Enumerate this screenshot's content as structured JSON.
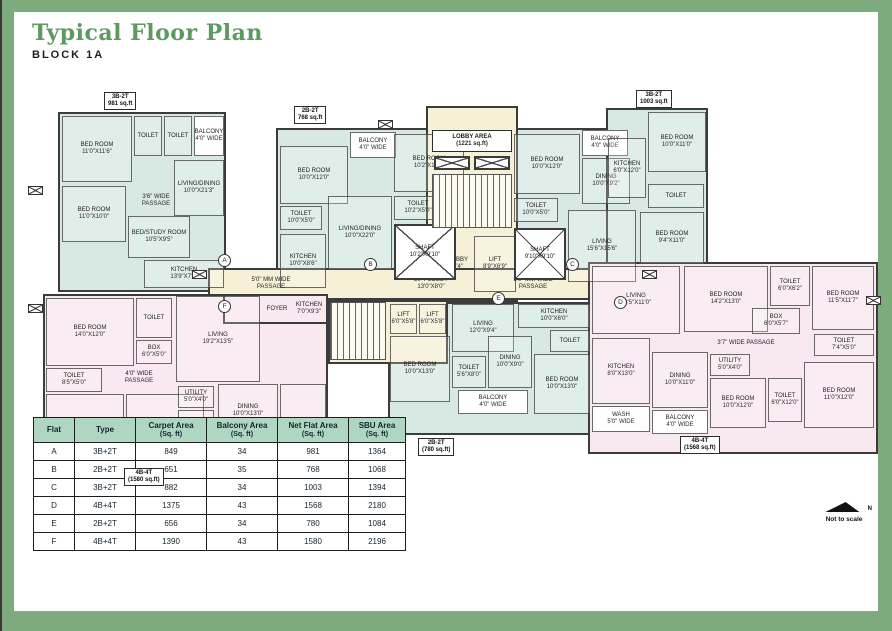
{
  "page": {
    "title": "Typical Floor Plan",
    "subtitle": "BLOCK 1A",
    "footer": {
      "north": "N",
      "note": "Not to scale"
    }
  },
  "colors": {
    "frame": "#7dab7d",
    "title": "#5d9a5f",
    "wall": "#3c3c3c",
    "teal_flat": "#d8e9e4",
    "pink_flat": "#f8e8f0",
    "lobby_cream": "#f6f0d6",
    "table_header": "#aed6c1"
  },
  "plan": {
    "zones": [
      {
        "name": "flat-a",
        "fill": "teal",
        "x": 30,
        "y": 22,
        "w": 168,
        "h": 180
      },
      {
        "name": "flat-b",
        "fill": "teal",
        "x": 248,
        "y": 38,
        "w": 192,
        "h": 172
      },
      {
        "name": "flat-c-main",
        "fill": "teal",
        "x": 482,
        "y": 38,
        "w": 178,
        "h": 172
      },
      {
        "name": "flat-c-wing",
        "fill": "teal",
        "x": 578,
        "y": 18,
        "w": 102,
        "h": 158
      },
      {
        "name": "lobby-tower",
        "fill": "cream",
        "x": 398,
        "y": 16,
        "w": 92,
        "h": 196
      },
      {
        "name": "corridor",
        "fill": "cream",
        "x": 180,
        "y": 178,
        "w": 430,
        "h": 32
      },
      {
        "name": "flat-f",
        "fill": "pink",
        "x": 15,
        "y": 204,
        "w": 285,
        "h": 172
      },
      {
        "name": "flat-f-arm",
        "fill": "pink",
        "x": 195,
        "y": 204,
        "w": 105,
        "h": 30
      },
      {
        "name": "flat-e",
        "fill": "teal",
        "x": 360,
        "y": 212,
        "w": 205,
        "h": 133
      },
      {
        "name": "stair-core",
        "fill": "cream",
        "x": 300,
        "y": 210,
        "w": 120,
        "h": 64
      },
      {
        "name": "flat-d",
        "fill": "pink",
        "x": 560,
        "y": 172,
        "w": 290,
        "h": 192
      }
    ],
    "rooms": [
      {
        "x": 34,
        "y": 26,
        "w": 70,
        "h": 66,
        "label": "BED ROOM",
        "dims": "11'0\"X11'6\""
      },
      {
        "x": 106,
        "y": 26,
        "w": 28,
        "h": 40,
        "label": "TOILET",
        "dims": ""
      },
      {
        "x": 136,
        "y": 26,
        "w": 28,
        "h": 40,
        "label": "TOILET",
        "dims": ""
      },
      {
        "x": 166,
        "y": 26,
        "w": 30,
        "h": 40,
        "label": "BALCONY",
        "dims": "4'0\" WIDE",
        "style": "white"
      },
      {
        "x": 146,
        "y": 70,
        "w": 50,
        "h": 56,
        "label": "LIVING/DINING",
        "dims": "10'0\"X21'3\""
      },
      {
        "x": 34,
        "y": 96,
        "w": 64,
        "h": 56,
        "label": "BED ROOM",
        "dims": "11'0\"X10'0\""
      },
      {
        "x": 100,
        "y": 100,
        "w": 56,
        "h": 22,
        "label": "3'6\" WIDE",
        "dims": "PASSAGE",
        "style": "plain"
      },
      {
        "x": 100,
        "y": 126,
        "w": 62,
        "h": 42,
        "label": "BED/STUDY ROOM",
        "dims": "10'5\"X9'5\""
      },
      {
        "x": 116,
        "y": 170,
        "w": 80,
        "h": 28,
        "label": "KITCHEN",
        "dims": "13'9\"X7'0\""
      },
      {
        "x": 252,
        "y": 56,
        "w": 68,
        "h": 58,
        "label": "BED ROOM",
        "dims": "10'0\"X12'0\""
      },
      {
        "x": 322,
        "y": 42,
        "w": 46,
        "h": 26,
        "label": "BALCONY",
        "dims": "4'0\" WIDE",
        "style": "white"
      },
      {
        "x": 366,
        "y": 44,
        "w": 70,
        "h": 58,
        "label": "BED ROOM",
        "dims": "10'2\"X11'0\""
      },
      {
        "x": 252,
        "y": 116,
        "w": 42,
        "h": 24,
        "label": "TOILET",
        "dims": "10'0\"X5'0\""
      },
      {
        "x": 252,
        "y": 144,
        "w": 46,
        "h": 54,
        "label": "KITCHEN",
        "dims": "10'0\"X8'6\""
      },
      {
        "x": 300,
        "y": 106,
        "w": 64,
        "h": 74,
        "label": "LIVING/DINING",
        "dims": "10'0\"X22'0\""
      },
      {
        "x": 366,
        "y": 106,
        "w": 48,
        "h": 24,
        "label": "TOILET",
        "dims": "10'2\"X5'0\""
      },
      {
        "x": 404,
        "y": 40,
        "w": 80,
        "h": 22,
        "label": "LOBBY AREA",
        "dims": "(1221 sq.ft)",
        "style": "tagbox"
      },
      {
        "x": 406,
        "y": 86,
        "w": 20,
        "h": 10,
        "label": "UP",
        "dims": "",
        "style": "plain"
      },
      {
        "x": 406,
        "y": 98,
        "w": 20,
        "h": 10,
        "label": "DN",
        "dims": "",
        "style": "plain"
      },
      {
        "x": 402,
        "y": 146,
        "w": 42,
        "h": 56,
        "label": "LIFT LOBBY",
        "dims": "8'4\"X7'4\"",
        "style": "plain"
      },
      {
        "x": 446,
        "y": 146,
        "w": 42,
        "h": 56,
        "label": "LIFT",
        "dims": "8'9\"X6'9\""
      },
      {
        "x": 206,
        "y": 182,
        "w": 74,
        "h": 24,
        "label": "5'0\" MM WIDE",
        "dims": "PASSAGE",
        "style": "plain"
      },
      {
        "x": 370,
        "y": 182,
        "w": 66,
        "h": 24,
        "label": "LIFT LOBBY",
        "dims": "13'0\"X8'0\"",
        "style": "plain"
      },
      {
        "x": 468,
        "y": 182,
        "w": 74,
        "h": 24,
        "label": "5'0\" MM WIDE",
        "dims": "PASSAGE",
        "style": "plain"
      },
      {
        "x": 486,
        "y": 44,
        "w": 66,
        "h": 60,
        "label": "BED ROOM",
        "dims": "10'0\"X12'0\""
      },
      {
        "x": 554,
        "y": 40,
        "w": 46,
        "h": 26,
        "label": "BALCONY",
        "dims": "4'0\" WIDE",
        "style": "white"
      },
      {
        "x": 554,
        "y": 68,
        "w": 48,
        "h": 46,
        "label": "DINING",
        "dims": "10'0\"X9'2\""
      },
      {
        "x": 580,
        "y": 48,
        "w": 38,
        "h": 60,
        "label": "KITCHEN",
        "dims": "6'0\"X12'0\""
      },
      {
        "x": 620,
        "y": 22,
        "w": 58,
        "h": 60,
        "label": "BED ROOM",
        "dims": "10'0\"X11'0\""
      },
      {
        "x": 620,
        "y": 94,
        "w": 56,
        "h": 24,
        "label": "TOILET",
        "dims": ""
      },
      {
        "x": 612,
        "y": 122,
        "w": 64,
        "h": 52,
        "label": "BED ROOM",
        "dims": "9'4\"X11'0\""
      },
      {
        "x": 486,
        "y": 108,
        "w": 44,
        "h": 24,
        "label": "TOILET",
        "dims": "10'0\"X5'0\""
      },
      {
        "x": 540,
        "y": 120,
        "w": 68,
        "h": 72,
        "label": "LIVING",
        "dims": "15'6\"X15'6\""
      },
      {
        "x": 18,
        "y": 208,
        "w": 88,
        "h": 68,
        "label": "BED ROOM",
        "dims": "14'0\"X12'0\""
      },
      {
        "x": 108,
        "y": 208,
        "w": 36,
        "h": 40,
        "label": "TOILET",
        "dims": ""
      },
      {
        "x": 108,
        "y": 250,
        "w": 36,
        "h": 24,
        "label": "BOX",
        "dims": "6'0\"X5'0\""
      },
      {
        "x": 148,
        "y": 206,
        "w": 84,
        "h": 86,
        "label": "LIVING",
        "dims": "19'2\"X13'5\""
      },
      {
        "x": 234,
        "y": 208,
        "w": 30,
        "h": 22,
        "label": "FOYER",
        "dims": "",
        "style": "plain"
      },
      {
        "x": 264,
        "y": 206,
        "w": 34,
        "h": 26,
        "label": "KITCHEN",
        "dims": "7'0\"X9'3\"",
        "style": "plain"
      },
      {
        "x": 18,
        "y": 278,
        "w": 56,
        "h": 24,
        "label": "TOILET",
        "dims": "8'5\"X5'0\""
      },
      {
        "x": 78,
        "y": 276,
        "w": 66,
        "h": 24,
        "label": "4'0\" WIDE",
        "dims": "PASSAGE",
        "style": "plain"
      },
      {
        "x": 18,
        "y": 304,
        "w": 78,
        "h": 66,
        "label": "BEDROOM",
        "dims": "12'0\"X11'0\""
      },
      {
        "x": 98,
        "y": 304,
        "w": 78,
        "h": 66,
        "label": "BEDROOM",
        "dims": "12'0\"X11'0\""
      },
      {
        "x": 150,
        "y": 296,
        "w": 36,
        "h": 22,
        "label": "UTILITY",
        "dims": "5'0\"X4'0\""
      },
      {
        "x": 150,
        "y": 320,
        "w": 36,
        "h": 26,
        "label": "TOILET",
        "dims": ""
      },
      {
        "x": 190,
        "y": 294,
        "w": 60,
        "h": 54,
        "label": "DINING",
        "dims": "10'0\"X13'0\""
      },
      {
        "x": 190,
        "y": 350,
        "w": 60,
        "h": 22,
        "label": "BALCONY",
        "dims": "5'0\" WIDE",
        "style": "white"
      },
      {
        "x": 252,
        "y": 294,
        "w": 46,
        "h": 78,
        "label": "BED ROOM",
        "dims": ""
      },
      {
        "x": 306,
        "y": 214,
        "w": 22,
        "h": 10,
        "label": "DN",
        "dims": "",
        "style": "plain"
      },
      {
        "x": 332,
        "y": 214,
        "w": 22,
        "h": 10,
        "label": "UP",
        "dims": "",
        "style": "plain"
      },
      {
        "x": 362,
        "y": 214,
        "w": 27,
        "h": 30,
        "label": "LIFT",
        "dims": "6'0\"X5'8\""
      },
      {
        "x": 391,
        "y": 214,
        "w": 27,
        "h": 30,
        "label": "LIFT",
        "dims": "6'0\"X5'8\""
      },
      {
        "x": 424,
        "y": 214,
        "w": 62,
        "h": 48,
        "label": "LIVING",
        "dims": "12'0\"X9'4\""
      },
      {
        "x": 490,
        "y": 214,
        "w": 72,
        "h": 24,
        "label": "KITCHEN",
        "dims": "10'0\"X6'0\""
      },
      {
        "x": 522,
        "y": 240,
        "w": 40,
        "h": 22,
        "label": "TOILET",
        "dims": ""
      },
      {
        "x": 362,
        "y": 246,
        "w": 60,
        "h": 66,
        "label": "BED ROOM",
        "dims": "10'0\"X13'0\""
      },
      {
        "x": 424,
        "y": 266,
        "w": 34,
        "h": 32,
        "label": "TOILET",
        "dims": "5'6\"X8'0\""
      },
      {
        "x": 460,
        "y": 246,
        "w": 44,
        "h": 52,
        "label": "DINING",
        "dims": "10'0\"X9'0\""
      },
      {
        "x": 506,
        "y": 264,
        "w": 56,
        "h": 60,
        "label": "BED ROOM",
        "dims": "10'0\"X13'0\""
      },
      {
        "x": 430,
        "y": 300,
        "w": 70,
        "h": 24,
        "label": "BALCONY",
        "dims": "4'0\" WIDE",
        "style": "white"
      },
      {
        "x": 564,
        "y": 176,
        "w": 88,
        "h": 68,
        "label": "LIVING",
        "dims": "18'5\"X11'0\""
      },
      {
        "x": 656,
        "y": 176,
        "w": 84,
        "h": 66,
        "label": "BED ROOM",
        "dims": "14'2\"X13'0\""
      },
      {
        "x": 742,
        "y": 176,
        "w": 40,
        "h": 40,
        "label": "TOILET",
        "dims": "6'0\"X6'2\""
      },
      {
        "x": 784,
        "y": 176,
        "w": 62,
        "h": 64,
        "label": "BED ROOM",
        "dims": "11'5\"X11'7\""
      },
      {
        "x": 724,
        "y": 218,
        "w": 48,
        "h": 26,
        "label": "BOX",
        "dims": "6'0\"X5'7\""
      },
      {
        "x": 786,
        "y": 244,
        "w": 60,
        "h": 22,
        "label": "TOILET",
        "dims": "7'4\"X5'0\""
      },
      {
        "x": 668,
        "y": 246,
        "w": 100,
        "h": 14,
        "label": "3'7\" WIDE PASSAGE",
        "dims": "",
        "style": "plain"
      },
      {
        "x": 564,
        "y": 248,
        "w": 58,
        "h": 66,
        "label": "KITCHEN",
        "dims": "8'0\"X13'0\""
      },
      {
        "x": 624,
        "y": 262,
        "w": 56,
        "h": 56,
        "label": "DINING",
        "dims": "10'0\"X11'0\""
      },
      {
        "x": 682,
        "y": 264,
        "w": 40,
        "h": 22,
        "label": "UTILITY",
        "dims": "5'0\"X4'0\""
      },
      {
        "x": 682,
        "y": 288,
        "w": 56,
        "h": 50,
        "label": "BED ROOM",
        "dims": "10'0\"X12'0\""
      },
      {
        "x": 740,
        "y": 288,
        "w": 34,
        "h": 44,
        "label": "TOILET",
        "dims": "6'0\"X12'0\""
      },
      {
        "x": 776,
        "y": 272,
        "w": 70,
        "h": 66,
        "label": "BED ROOM",
        "dims": "11'0\"X12'0\""
      },
      {
        "x": 564,
        "y": 316,
        "w": 58,
        "h": 26,
        "label": "WASH",
        "dims": "5'0\" WIDE",
        "style": "white"
      },
      {
        "x": 624,
        "y": 320,
        "w": 56,
        "h": 24,
        "label": "BALCONY",
        "dims": "4'0\" WIDE",
        "style": "white"
      }
    ],
    "shafts": [
      {
        "x": 366,
        "y": 134,
        "w": 62,
        "h": 56,
        "label": "SHAFT",
        "dims": "10'2\"X9'10\""
      },
      {
        "x": 486,
        "y": 138,
        "w": 52,
        "h": 52,
        "label": "SHAFT",
        "dims": "9'10\"X9'10\""
      },
      {
        "x": 406,
        "y": 66,
        "w": 36,
        "h": 14,
        "label": "",
        "dims": ""
      },
      {
        "x": 446,
        "y": 66,
        "w": 36,
        "h": 14,
        "label": "",
        "dims": ""
      }
    ],
    "stairs": [
      {
        "x": 404,
        "y": 84,
        "w": 80,
        "h": 54
      },
      {
        "x": 302,
        "y": 212,
        "w": 56,
        "h": 58
      }
    ],
    "tags": [
      {
        "x": 76,
        "y": 2,
        "lines": [
          "3B-2T",
          "981 sq.ft"
        ]
      },
      {
        "x": 266,
        "y": 16,
        "lines": [
          "2B-2T",
          "768 sq.ft"
        ]
      },
      {
        "x": 608,
        "y": 0,
        "lines": [
          "3B-2T",
          "1003 sq.ft"
        ]
      },
      {
        "x": 96,
        "y": 378,
        "lines": [
          "4B-4T",
          "(1580 sq.ft)"
        ]
      },
      {
        "x": 390,
        "y": 348,
        "lines": [
          "2B-2T",
          "(780 sq.ft)"
        ]
      },
      {
        "x": 652,
        "y": 346,
        "lines": [
          "4B-4T",
          "(1568 sq.ft)"
        ]
      }
    ],
    "entries": [
      {
        "x": 190,
        "y": 164,
        "letter": "A"
      },
      {
        "x": 336,
        "y": 168,
        "letter": "B"
      },
      {
        "x": 538,
        "y": 168,
        "letter": "C"
      },
      {
        "x": 586,
        "y": 206,
        "letter": "D"
      },
      {
        "x": 464,
        "y": 202,
        "letter": "E"
      },
      {
        "x": 190,
        "y": 210,
        "letter": "F"
      }
    ],
    "markers": [
      {
        "x": 0,
        "y": 96
      },
      {
        "x": 0,
        "y": 214
      },
      {
        "x": 838,
        "y": 206
      },
      {
        "x": 164,
        "y": 180
      },
      {
        "x": 614,
        "y": 180
      },
      {
        "x": 350,
        "y": 30
      }
    ]
  },
  "table": {
    "headers": [
      {
        "line1": "Flat",
        "line2": ""
      },
      {
        "line1": "Type",
        "line2": ""
      },
      {
        "line1": "Carpet Area",
        "line2": "(Sq. ft)"
      },
      {
        "line1": "Balcony Area",
        "line2": "(Sq. ft)"
      },
      {
        "line1": "Net Flat Area",
        "line2": "(Sq. ft)"
      },
      {
        "line1": "SBU Area",
        "line2": "(Sq. ft)"
      }
    ],
    "rows": [
      [
        "A",
        "3B+2T",
        "849",
        "34",
        "981",
        "1364"
      ],
      [
        "B",
        "2B+2T",
        "651",
        "35",
        "768",
        "1068"
      ],
      [
        "C",
        "3B+2T",
        "882",
        "34",
        "1003",
        "1394"
      ],
      [
        "D",
        "4B+4T",
        "1375",
        "43",
        "1568",
        "2180"
      ],
      [
        "E",
        "2B+2T",
        "656",
        "34",
        "780",
        "1084"
      ],
      [
        "F",
        "4B+4T",
        "1390",
        "43",
        "1580",
        "2196"
      ]
    ]
  }
}
